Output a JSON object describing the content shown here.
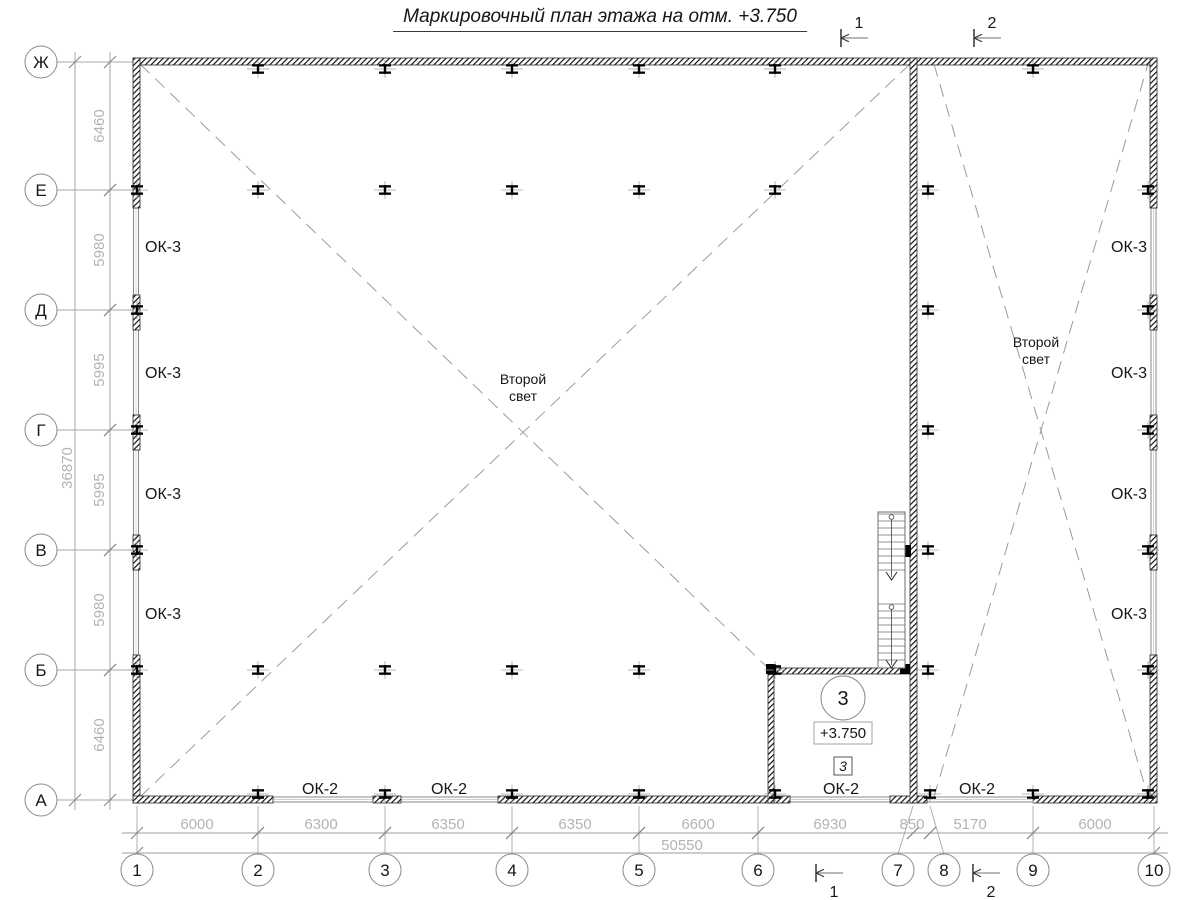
{
  "title": "Маркировочный план этажа на отм. +3.750",
  "colors": {
    "paper": "#ffffff",
    "wall_hatch": "#111111",
    "wall_stroke": "#2a2a2a",
    "window_line": "#7d7d7d",
    "dim_text": "#b3b3b3",
    "dim_line": "#9c9c9c",
    "axis_line": "#a8a8a8",
    "dash_line": "#9b9b9b",
    "label_text": "#161616",
    "column_black": "#000000",
    "stair_line": "#6f6f6f"
  },
  "grid": {
    "rows": [
      {
        "label": "Ж",
        "y": 62
      },
      {
        "label": "Е",
        "y": 190
      },
      {
        "label": "Д",
        "y": 310
      },
      {
        "label": "Г",
        "y": 430
      },
      {
        "label": "В",
        "y": 550
      },
      {
        "label": "Б",
        "y": 670
      },
      {
        "label": "А",
        "y": 800
      }
    ],
    "cols": [
      {
        "label": "1",
        "cx": 137,
        "ax": 137
      },
      {
        "label": "2",
        "cx": 258,
        "ax": 258
      },
      {
        "label": "3",
        "cx": 385,
        "ax": 385
      },
      {
        "label": "4",
        "cx": 512,
        "ax": 512
      },
      {
        "label": "5",
        "cx": 639,
        "ax": 639
      },
      {
        "label": "6",
        "cx": 758,
        "ax": 758
      },
      {
        "label": "7",
        "cx": 898,
        "ax": 913
      },
      {
        "label": "8",
        "cx": 944,
        "ax": 930
      },
      {
        "label": "9",
        "cx": 1033,
        "ax": 1033
      },
      {
        "label": "10",
        "cx": 1154,
        "ax": 1154
      }
    ]
  },
  "dims": {
    "left": {
      "segments": [
        {
          "value": "6460",
          "a": 62,
          "b": 190
        },
        {
          "value": "5980",
          "a": 190,
          "b": 310
        },
        {
          "value": "5995",
          "a": 310,
          "b": 430
        },
        {
          "value": "5995",
          "a": 430,
          "b": 550
        },
        {
          "value": "5980",
          "a": 550,
          "b": 670
        },
        {
          "value": "6460",
          "a": 670,
          "b": 800
        }
      ],
      "total": "36870",
      "total_x": 72,
      "total_y": 468
    },
    "bottom": {
      "segments": [
        {
          "value": "6000",
          "a": 137,
          "b": 258,
          "tx": 197
        },
        {
          "value": "6300",
          "a": 258,
          "b": 385,
          "tx": 321
        },
        {
          "value": "6350",
          "a": 385,
          "b": 512,
          "tx": 448
        },
        {
          "value": "6350",
          "a": 512,
          "b": 639,
          "tx": 575
        },
        {
          "value": "6600",
          "a": 639,
          "b": 758,
          "tx": 698
        },
        {
          "value": "6930",
          "a": 758,
          "b": 913,
          "tx": 830
        },
        {
          "value": "850",
          "a": 913,
          "b": 930,
          "tx": 912
        },
        {
          "value": "5170",
          "a": 930,
          "b": 1033,
          "tx": 970
        },
        {
          "value": "6000",
          "a": 1033,
          "b": 1154,
          "tx": 1095
        }
      ],
      "total": "50550",
      "total_x": 682,
      "total_y": 850
    }
  },
  "window_labels": [
    {
      "text": "ОК-3",
      "x": 145,
      "y": 247,
      "anchor": "start"
    },
    {
      "text": "ОК-3",
      "x": 145,
      "y": 373,
      "anchor": "start"
    },
    {
      "text": "ОК-3",
      "x": 145,
      "y": 494,
      "anchor": "start"
    },
    {
      "text": "ОК-3",
      "x": 145,
      "y": 614,
      "anchor": "start"
    },
    {
      "text": "ОК-3",
      "x": 1147,
      "y": 247,
      "anchor": "end"
    },
    {
      "text": "ОК-3",
      "x": 1147,
      "y": 373,
      "anchor": "end"
    },
    {
      "text": "ОК-3",
      "x": 1147,
      "y": 494,
      "anchor": "end"
    },
    {
      "text": "ОК-3",
      "x": 1147,
      "y": 614,
      "anchor": "end"
    },
    {
      "text": "ОК-2",
      "x": 320,
      "y": 789,
      "anchor": "middle"
    },
    {
      "text": "ОК-2",
      "x": 449,
      "y": 789,
      "anchor": "middle"
    },
    {
      "text": "ОК-2",
      "x": 841,
      "y": 789,
      "anchor": "middle"
    },
    {
      "text": "ОК-2",
      "x": 977,
      "y": 789,
      "anchor": "middle"
    }
  ],
  "second_light": [
    {
      "line1": "Второй",
      "line2": "свет",
      "x": 523,
      "y": 384
    },
    {
      "line1": "Второй",
      "line2": "свет",
      "x": 1036,
      "y": 347
    }
  ],
  "room": {
    "number": "3",
    "number_x": 843,
    "number_y": 698,
    "number_r": 22,
    "elevation": "+3.750",
    "elev_x": 843,
    "elev_y": 733,
    "door_mark": "3",
    "door_x": 843,
    "door_y": 766
  },
  "section_marks": {
    "top": [
      {
        "label": "1",
        "x": 841,
        "y": 38
      },
      {
        "label": "2",
        "x": 974,
        "y": 38
      }
    ],
    "bottom": [
      {
        "label": "1",
        "x": 816,
        "y": 873
      },
      {
        "label": "2",
        "x": 973,
        "y": 873
      }
    ]
  },
  "plan_geometry": {
    "walls": [
      [
        133,
        58,
        1024,
        7
      ],
      [
        133,
        58,
        7,
        150
      ],
      [
        133,
        295,
        7,
        35
      ],
      [
        133,
        415,
        7,
        35
      ],
      [
        133,
        535,
        7,
        35
      ],
      [
        133,
        655,
        7,
        148
      ],
      [
        1150,
        58,
        7,
        150
      ],
      [
        1150,
        295,
        7,
        35
      ],
      [
        1150,
        415,
        7,
        35
      ],
      [
        1150,
        535,
        7,
        35
      ],
      [
        1150,
        655,
        7,
        148
      ],
      [
        133,
        796,
        140,
        7
      ],
      [
        373,
        796,
        28,
        7
      ],
      [
        498,
        796,
        292,
        7
      ],
      [
        890,
        796,
        37,
        7
      ],
      [
        1033,
        796,
        124,
        7
      ],
      [
        910,
        58,
        7,
        745
      ],
      [
        768,
        668,
        6,
        135
      ],
      [
        768,
        668,
        142,
        6
      ]
    ],
    "squares": [
      [
        766,
        664,
        10,
        10
      ],
      [
        900,
        664,
        10,
        10
      ],
      [
        903,
        545,
        8,
        12
      ]
    ],
    "windows": [
      [
        133.5,
        208,
        5,
        87
      ],
      [
        133.5,
        330,
        5,
        85
      ],
      [
        133.5,
        450,
        5,
        85
      ],
      [
        133.5,
        570,
        5,
        85
      ],
      [
        1151,
        208,
        5,
        87
      ],
      [
        1151,
        330,
        5,
        85
      ],
      [
        1151,
        450,
        5,
        85
      ],
      [
        1151,
        570,
        5,
        85
      ],
      [
        273,
        797,
        100,
        5
      ],
      [
        401,
        797,
        97,
        5
      ],
      [
        790,
        797,
        100,
        5
      ],
      [
        927,
        797,
        106,
        5
      ]
    ],
    "columns": [
      {
        "y": 69,
        "xs": [
          258,
          385,
          512,
          639,
          775,
          1033
        ]
      },
      {
        "y": 190,
        "xs": [
          137,
          258,
          385,
          512,
          639,
          775,
          928,
          1148
        ]
      },
      {
        "y": 310,
        "xs": [
          137,
          928,
          1148
        ]
      },
      {
        "y": 430,
        "xs": [
          137,
          928,
          1148
        ]
      },
      {
        "y": 550,
        "xs": [
          137,
          928,
          1148
        ]
      },
      {
        "y": 670,
        "xs": [
          137,
          258,
          385,
          512,
          639,
          775,
          928,
          1148
        ]
      },
      {
        "y": 794,
        "xs": [
          258,
          385,
          512,
          639,
          775,
          930,
          1033,
          1148
        ]
      }
    ],
    "diagonals": [
      [
        140,
        64,
        768,
        668
      ],
      [
        140,
        797,
        910,
        64
      ],
      [
        934,
        64,
        1148,
        797
      ],
      [
        934,
        797,
        1148,
        64
      ]
    ],
    "stair": {
      "x": 878,
      "y": 512,
      "w": 27,
      "h": 156,
      "cx": 891.5,
      "step": 7,
      "flights": [
        {
          "top": 514,
          "bottom": 576
        },
        {
          "top": 604,
          "bottom": 662
        }
      ],
      "arrows": [
        580,
        668
      ],
      "starts": [
        517,
        607
      ]
    }
  }
}
